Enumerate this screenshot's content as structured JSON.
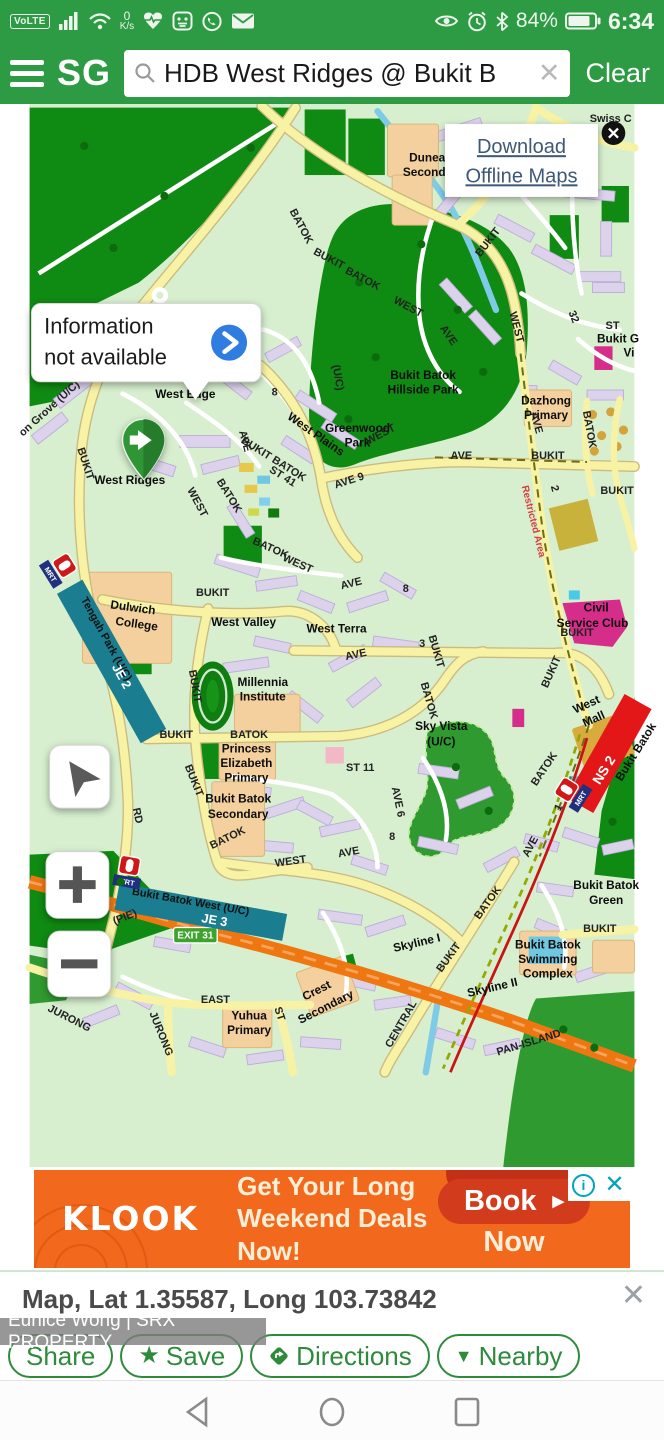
{
  "status_bar": {
    "volte": "VoLTE",
    "kps_value": "0",
    "kps_unit": "K/s",
    "battery": "84%",
    "time": "6:34"
  },
  "header": {
    "logo": "SG",
    "search_value": "HDB West Ridges @ Bukit B",
    "clear": "Clear"
  },
  "map": {
    "offline_card": {
      "line1": "Download",
      "line2": "Offline Maps"
    },
    "callout": {
      "line1": "Information",
      "line2": "not available"
    },
    "exit_badge": "EXIT 31",
    "mrt": {
      "logo": "MRT",
      "je2_station": "Tengah Park (U/C)",
      "je2_code": "JE 2",
      "je3_station": "Bukit Batok West (U/C)",
      "je3_code": "JE 3",
      "ns2_code": "NS 2",
      "ns2_station": "Bukit Batok"
    },
    "labels": [
      {
        "t": "Dunearn"
      },
      {
        "t": "Secondary"
      },
      {
        "t": "Bukit Batok"
      },
      {
        "t": "Hillside Park"
      },
      {
        "t": "Greenwood"
      },
      {
        "t": "Park"
      },
      {
        "t": "Dazhong"
      },
      {
        "t": "Primary"
      },
      {
        "t": "West Edge"
      },
      {
        "t": "West Ridges"
      },
      {
        "t": "West Plains"
      },
      {
        "t": "BUKIT BATOK"
      },
      {
        "t": "ST 41"
      },
      {
        "t": "West Valley"
      },
      {
        "t": "West Terra"
      },
      {
        "t": "Millennia"
      },
      {
        "t": "Institute"
      },
      {
        "t": "Princess"
      },
      {
        "t": "Elizabeth"
      },
      {
        "t": "Primary"
      },
      {
        "t": "Bukit Batok"
      },
      {
        "t": "Secondary"
      },
      {
        "t": "Sky Vista"
      },
      {
        "t": "(U/C)"
      },
      {
        "t": "Civil"
      },
      {
        "t": "Service Club"
      },
      {
        "t": "West"
      },
      {
        "t": "Mall"
      },
      {
        "t": "Bukit Batok"
      },
      {
        "t": "Green"
      },
      {
        "t": "Bukit Batok"
      },
      {
        "t": "Swimming"
      },
      {
        "t": "Complex"
      },
      {
        "t": "Skyline I"
      },
      {
        "t": "Skyline II"
      },
      {
        "t": "Crest"
      },
      {
        "t": "Secondary"
      },
      {
        "t": "Yuhua"
      },
      {
        "t": "Primary"
      },
      {
        "t": "Dulwich"
      },
      {
        "t": "College"
      },
      {
        "t": "BATOK"
      },
      {
        "t": "BUKIT"
      },
      {
        "t": "BATOK"
      },
      {
        "t": "WEST"
      },
      {
        "t": "AVE"
      },
      {
        "t": "BUKIT"
      },
      {
        "t": "BATOK"
      },
      {
        "t": "BUKIT"
      },
      {
        "t": "(U/C)"
      },
      {
        "t": "BUKIT"
      },
      {
        "t": "on Grove (U/C)"
      },
      {
        "t": "AVE"
      },
      {
        "t": "8"
      },
      {
        "t": "WEST"
      },
      {
        "t": "BATOK"
      },
      {
        "t": "BATOK"
      },
      {
        "t": "WEST"
      },
      {
        "t": "BUKIT"
      },
      {
        "t": "WEST"
      },
      {
        "t": "AVE"
      },
      {
        "t": "AVE 9"
      },
      {
        "t": "BUKIT"
      },
      {
        "t": "WEST"
      },
      {
        "t": "AVE"
      },
      {
        "t": "2"
      },
      {
        "t": "BUKIT"
      },
      {
        "t": "Restricted Area"
      },
      {
        "t": "AVE"
      },
      {
        "t": "8"
      },
      {
        "t": "AVE"
      },
      {
        "t": "3"
      },
      {
        "t": "BUKIT"
      },
      {
        "t": "BATOK"
      },
      {
        "t": "BUKIT"
      },
      {
        "t": "BATOK"
      },
      {
        "t": "BUKIT"
      },
      {
        "t": "BUKIT"
      },
      {
        "t": "RD"
      },
      {
        "t": "BATOK"
      },
      {
        "t": "WEST"
      },
      {
        "t": "ST  11"
      },
      {
        "t": "AVE 6"
      },
      {
        "t": "8"
      },
      {
        "t": "AVE"
      },
      {
        "t": "BATOK"
      },
      {
        "t": "BUKIT"
      },
      {
        "t": "AVE"
      },
      {
        "t": "1"
      },
      {
        "t": "BUKIT"
      },
      {
        "t": "BATOK"
      },
      {
        "t": "BUKIT"
      },
      {
        "t": "CENTRAL"
      },
      {
        "t": "EAST"
      },
      {
        "t": "JURONG"
      },
      {
        "t": "JURONG"
      },
      {
        "t": "ST"
      },
      {
        "t": "32"
      },
      {
        "t": "ST"
      },
      {
        "t": "Bukit G"
      },
      {
        "t": "Vi"
      },
      {
        "t": "Swiss C"
      },
      {
        "t": "(PIE)"
      },
      {
        "t": "PAN-ISLAND"
      }
    ]
  },
  "ad": {
    "brand": "KLOOK",
    "line1": "Get Your Long",
    "line2": "Weekend Deals Now!",
    "cta1": "Book",
    "cta2": "Now"
  },
  "bottom_sheet": {
    "title": "Map, Lat 1.35587, Long 103.73842",
    "watermark": "Eunice Wong | SRX PROPERTY",
    "buttons": {
      "share": "Share",
      "save": "Save",
      "directions": "Directions",
      "nearby": "Nearby"
    }
  }
}
